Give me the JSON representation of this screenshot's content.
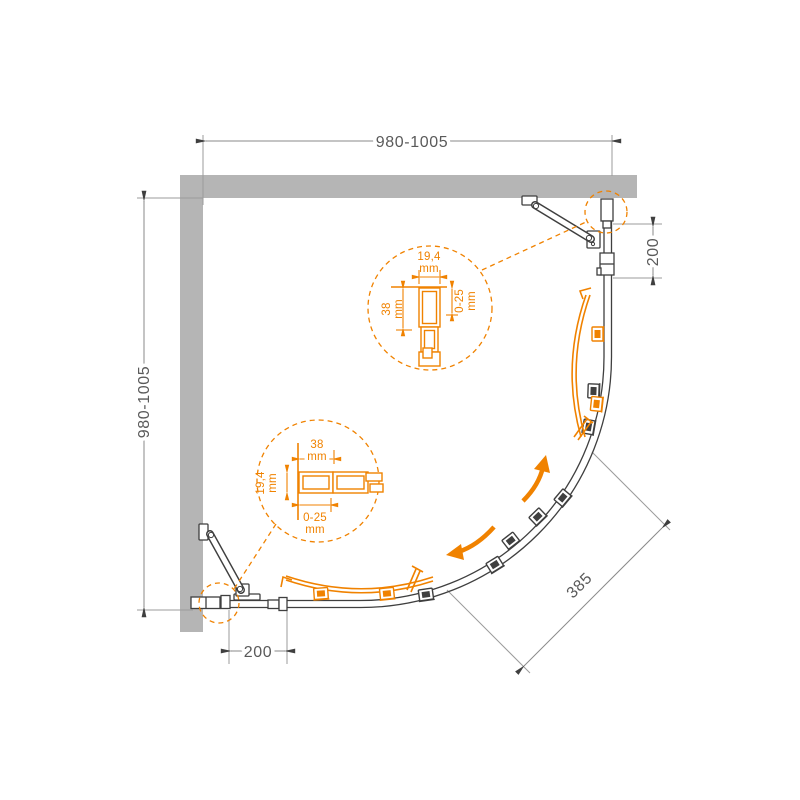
{
  "diagram_title": "quarter-round-shower-enclosure-dimension-drawing",
  "colors": {
    "accent": "#F08200",
    "wall": "#B5B5B5",
    "line": "#3F3F3F",
    "dimtext": "#5A5A5A"
  },
  "dims": {
    "top_width": "980-1005",
    "left_height": "980-1005",
    "right_segment": "200",
    "bottom_segment": "200",
    "diagonal": "385"
  },
  "detail_top": {
    "width": "19,4",
    "width_unit": "mm",
    "depth": "38",
    "depth_unit": "mm",
    "adjust": "0-25",
    "adjust_unit": "mm"
  },
  "detail_left": {
    "width": "38",
    "width_unit": "mm",
    "depth": "19,4",
    "depth_unit": "mm",
    "adjust": "0-25",
    "adjust_unit": "mm"
  }
}
